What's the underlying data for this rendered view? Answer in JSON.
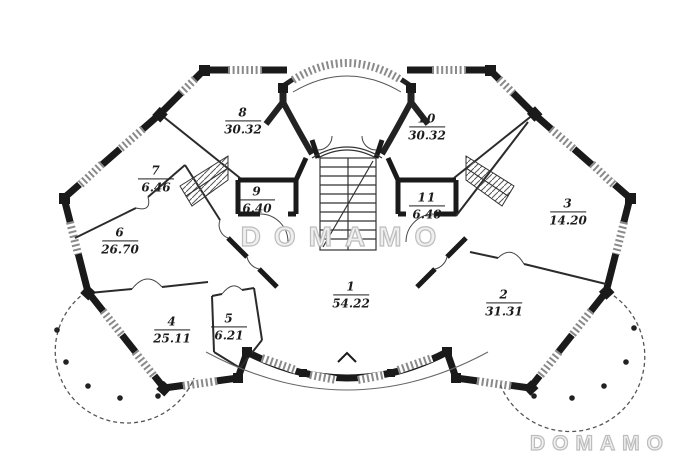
{
  "title": "apartment-floor-plan",
  "watermarks": {
    "center": "DOMAMO",
    "corner": "DOMAMO"
  },
  "plan": {
    "rooms": [
      {
        "number": "1",
        "area": "54.22"
      },
      {
        "number": "2",
        "area": "31.31"
      },
      {
        "number": "3",
        "area": "14.20"
      },
      {
        "number": "4",
        "area": "25.11"
      },
      {
        "number": "5",
        "area": "6.21"
      },
      {
        "number": "6",
        "area": "26.70"
      },
      {
        "number": "7",
        "area": "6.46"
      },
      {
        "number": "8",
        "area": "30.32"
      },
      {
        "number": "9",
        "area": "6.40"
      },
      {
        "number": "10",
        "area": "30.32"
      },
      {
        "number": "11",
        "area": "6.40"
      }
    ]
  },
  "colors": {
    "wall": "#1a1a1a",
    "window_hatch": "#8a8a8a",
    "watermark": "#bdbdbd"
  }
}
